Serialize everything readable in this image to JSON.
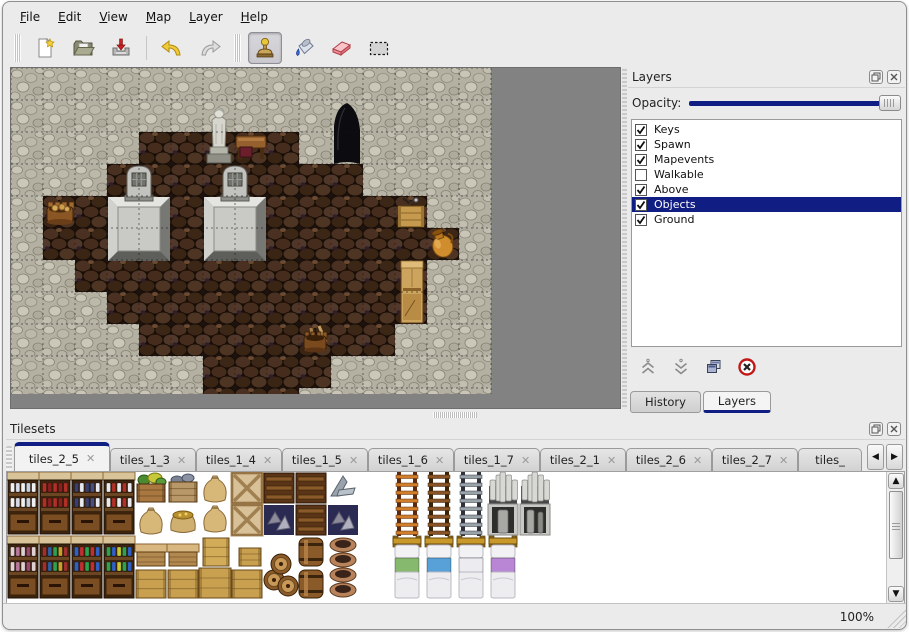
{
  "menu_bar": {
    "items": [
      "File",
      "Edit",
      "View",
      "Map",
      "Layer",
      "Help"
    ]
  },
  "toolbar": {
    "buttons": [
      "new",
      "open",
      "save",
      "undo",
      "redo",
      "stamp",
      "fill",
      "eraser",
      "select"
    ],
    "active_tool": "stamp"
  },
  "layers_panel": {
    "title": "Layers",
    "opacity_label": "Opacity:",
    "opacity_percent": 100,
    "layers": [
      {
        "name": "Keys",
        "checked": true,
        "selected": false
      },
      {
        "name": "Spawn",
        "checked": true,
        "selected": false
      },
      {
        "name": "Mapevents",
        "checked": true,
        "selected": false
      },
      {
        "name": "Walkable",
        "checked": false,
        "selected": false
      },
      {
        "name": "Above",
        "checked": true,
        "selected": false
      },
      {
        "name": "Objects",
        "checked": true,
        "selected": true
      },
      {
        "name": "Ground",
        "checked": true,
        "selected": false
      }
    ],
    "tabs": [
      {
        "label": "History",
        "active": false
      },
      {
        "label": "Layers",
        "active": true
      }
    ]
  },
  "tilesets_panel": {
    "title": "Tilesets",
    "tabs": [
      {
        "label": "tiles_2_5",
        "active": true
      },
      {
        "label": "tiles_1_3",
        "active": false
      },
      {
        "label": "tiles_1_4",
        "active": false
      },
      {
        "label": "tiles_1_5",
        "active": false
      },
      {
        "label": "tiles_1_6",
        "active": false
      },
      {
        "label": "tiles_1_7",
        "active": false
      },
      {
        "label": "tiles_2_1",
        "active": false
      },
      {
        "label": "tiles_2_6",
        "active": false
      },
      {
        "label": "tiles_2_7",
        "active": false
      },
      {
        "label": "tiles_",
        "active": false,
        "truncated": true
      }
    ]
  },
  "status_bar": {
    "zoom": "100%"
  },
  "colors": {
    "accent": "#101d82",
    "selection": "#101d82",
    "canvas_bg": "#828282",
    "wall": "#b4b1a3",
    "floor": "#2a1a10"
  },
  "map_view": {
    "tile_size": 32,
    "map_width_px": 480,
    "map_height_px": 326,
    "floor_rows": [
      {
        "row": 2,
        "from": 4,
        "to": 8
      },
      {
        "row": 3,
        "from": 3,
        "to": 10
      },
      {
        "row": 4,
        "from": 1,
        "to": 12
      },
      {
        "row": 5,
        "from": 1,
        "to": 13
      },
      {
        "row": 6,
        "from": 2,
        "to": 12
      },
      {
        "row": 7,
        "from": 3,
        "to": 12
      },
      {
        "row": 8,
        "from": 4,
        "to": 11
      },
      {
        "row": 9,
        "from": 6,
        "to": 9
      },
      {
        "row": 10,
        "from": 6,
        "to": 8
      }
    ],
    "objects": [
      {
        "type": "grave",
        "col": 3,
        "row": 3
      },
      {
        "type": "grave",
        "col": 6,
        "row": 3
      },
      {
        "type": "cave",
        "col": 10,
        "row": 1
      },
      {
        "type": "statue",
        "col": 6,
        "row": 1
      },
      {
        "type": "table",
        "col": 7,
        "row": 2
      },
      {
        "type": "basket-food",
        "col": 1,
        "row": 4
      },
      {
        "type": "crate-tools",
        "col": 12,
        "row": 4
      },
      {
        "type": "amphora",
        "col": 13,
        "row": 5
      },
      {
        "type": "cabinet",
        "col": 12,
        "row": 6
      },
      {
        "type": "basket-tools",
        "col": 9,
        "row": 8
      }
    ]
  },
  "tileset_grid": {
    "tile_size": 32,
    "items": [
      {
        "type": "shelfA",
        "c": 0,
        "r": 0,
        "v": "white"
      },
      {
        "type": "shelfA",
        "c": 1,
        "r": 0,
        "v": "red"
      },
      {
        "type": "shelfA",
        "c": 2,
        "r": 0,
        "v": "navy"
      },
      {
        "type": "shelfA",
        "c": 3,
        "r": 0,
        "v": "redwhite"
      },
      {
        "type": "planter",
        "c": 4,
        "r": 0
      },
      {
        "type": "sack",
        "c": 4,
        "r": 1
      },
      {
        "type": "orecrate",
        "c": 5,
        "r": 0
      },
      {
        "type": "opensack",
        "c": 5,
        "r": 1
      },
      {
        "type": "sack2",
        "c": 6,
        "r": 0
      },
      {
        "type": "xcrate",
        "c": 7,
        "r": 0
      },
      {
        "type": "xcrate",
        "c": 7,
        "r": 1
      },
      {
        "type": "bandcrate",
        "c": 8,
        "r": 0
      },
      {
        "type": "navypile",
        "c": 8,
        "r": 1
      },
      {
        "type": "bandcrate",
        "c": 9,
        "r": 0
      },
      {
        "type": "bandcrate",
        "c": 9,
        "r": 1
      },
      {
        "type": "scrap",
        "c": 10,
        "r": 0
      },
      {
        "type": "navypile",
        "c": 10,
        "r": 1
      },
      {
        "type": "ladder",
        "c": 12,
        "r": 0,
        "v": "orange"
      },
      {
        "type": "ladder",
        "c": 13,
        "r": 0,
        "v": "brown"
      },
      {
        "type": "ladder",
        "c": 14,
        "r": 0,
        "v": "gray"
      },
      {
        "type": "arch",
        "c": 15,
        "r": 0
      },
      {
        "type": "stonedoor",
        "c": 15,
        "r": 1,
        "v": "closed"
      },
      {
        "type": "arch",
        "c": 16,
        "r": 0
      },
      {
        "type": "stonedoor",
        "c": 16,
        "r": 1,
        "v": "open"
      },
      {
        "type": "shelfB",
        "c": 0,
        "r": 2,
        "v": "jars"
      },
      {
        "type": "shelfB",
        "c": 1,
        "r": 2,
        "v": "books"
      },
      {
        "type": "shelfB",
        "c": 2,
        "r": 2,
        "v": "potions"
      },
      {
        "type": "shelfB",
        "c": 3,
        "r": 2,
        "v": "potions2"
      },
      {
        "type": "counter",
        "c": 4,
        "r": 2
      },
      {
        "type": "crate",
        "c": 4,
        "r": 3
      },
      {
        "type": "counter",
        "c": 5,
        "r": 2
      },
      {
        "type": "crate",
        "c": 5,
        "r": 3
      },
      {
        "type": "cratestack",
        "c": 6,
        "r": 2
      },
      {
        "type": "smallcrate",
        "c": 7,
        "r": 2
      },
      {
        "type": "crate",
        "c": 7,
        "r": 3
      },
      {
        "type": "barrelpile",
        "c": 8,
        "r": 2
      },
      {
        "type": "barrelstack",
        "c": 9,
        "r": 2
      },
      {
        "type": "potstack",
        "c": 10,
        "r": 2
      },
      {
        "type": "bed",
        "c": 12,
        "r": 2,
        "v": "#86b96e"
      },
      {
        "type": "bed",
        "c": 13,
        "r": 2,
        "v": "#58a0d8"
      },
      {
        "type": "bed",
        "c": 14,
        "r": 2,
        "v": "#ececf0"
      },
      {
        "type": "bed",
        "c": 15,
        "r": 2,
        "v": "#b886d4"
      }
    ]
  }
}
